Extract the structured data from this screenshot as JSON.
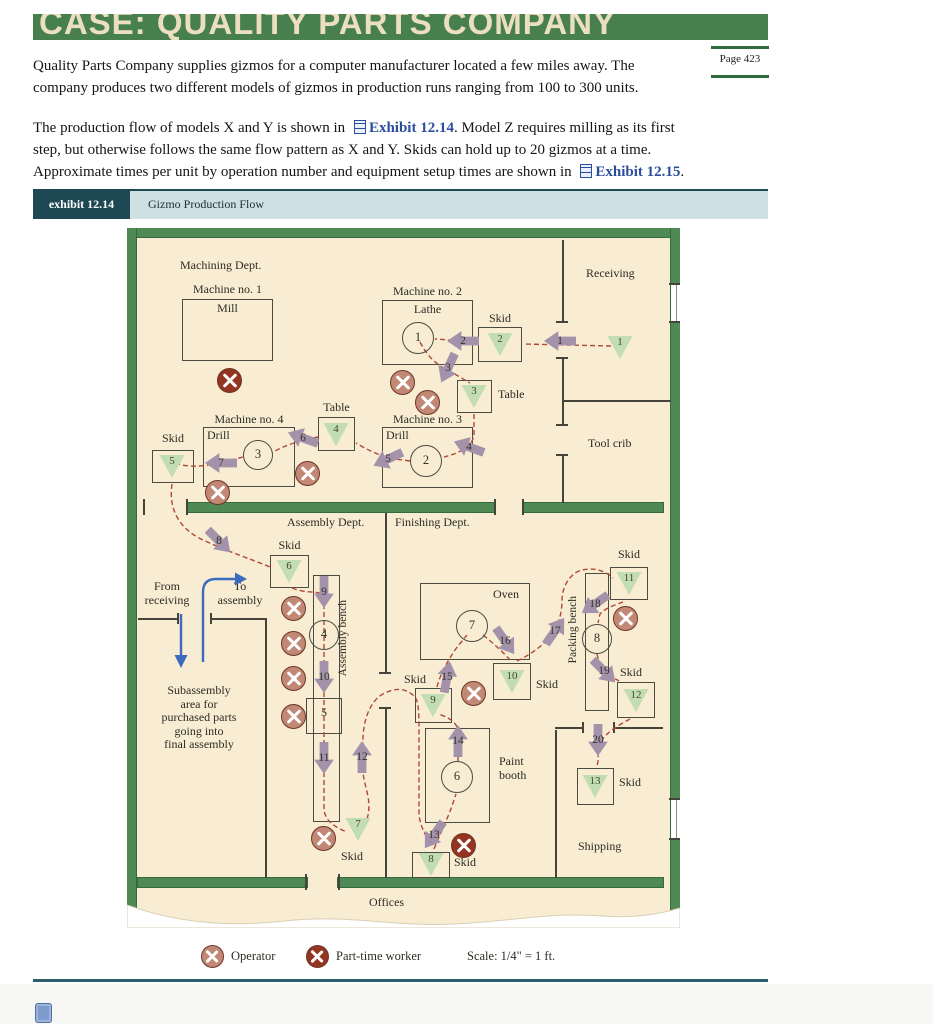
{
  "page": {
    "title": "CASE: QUALITY PARTS COMPANY",
    "page_badge": "Page 423",
    "para1_line1": "Quality Parts Company supplies gizmos for a computer manufacturer located a few miles away. The",
    "para1_line2": "company produces two different models of gizmos in production runs ranging from 100 to 300 units.",
    "para2": {
      "pre1": "The production flow of models X and Y is shown in ",
      "link1": "Exhibit 12.14",
      "mid1": ". Model Z requires milling as its first",
      "line2": "step, but otherwise follows the same flow pattern as X and Y. Skids can hold up to 20 gizmos at a time.",
      "pre3": "Approximate times per unit by operation number and equipment setup times are shown in ",
      "link3": "Exhibit 12.15",
      "post3": "."
    },
    "exhibit_tag": "exhibit 12.14",
    "exhibit_title": "Gizmo Production Flow",
    "legend": {
      "operator": "Operator",
      "part_time": "Part-time worker",
      "scale": "Scale: 1/4\" = 1 ft."
    }
  },
  "colors": {
    "header_green": "#47804e",
    "wall_green": "#4f8a55",
    "floor_cream": "#f8ecd2",
    "exhibit_tag_bg": "#1e4854",
    "exhibit_strip_bg": "#cfdfe4",
    "flow_dash_red": "#b04838",
    "arrow_mauve": "#a392aa",
    "triangle_green": "#c3ddb2",
    "operator_fill": "#c18876",
    "part_time_fill": "#943421",
    "link_blue": "#2b4d9e",
    "blue_arrow": "#3c6cc0"
  },
  "diagram": {
    "green_walls": [
      [
        0,
        0,
        553,
        9
      ],
      [
        0,
        0,
        9,
        690
      ],
      [
        544,
        0,
        9,
        690
      ],
      [
        60,
        275,
        308,
        9
      ],
      [
        396,
        275,
        140,
        9
      ],
      [
        11,
        650,
        169,
        9
      ],
      [
        211,
        650,
        325,
        9
      ]
    ],
    "door_gaps": [
      [
        544,
        57,
        9,
        36
      ],
      [
        544,
        572,
        9,
        38
      ]
    ],
    "black_walls": [
      [
        435,
        12,
        2,
        82
      ],
      [
        435,
        130,
        2,
        67
      ],
      [
        435,
        227,
        2,
        48
      ],
      [
        435,
        172,
        109,
        2
      ],
      [
        11,
        390,
        40,
        2
      ],
      [
        83,
        390,
        55,
        2
      ],
      [
        138,
        390,
        2,
        260
      ],
      [
        258,
        285,
        2,
        160
      ],
      [
        258,
        480,
        2,
        170
      ],
      [
        428,
        502,
        2,
        148
      ],
      [
        428,
        499,
        28,
        2
      ],
      [
        488,
        499,
        48,
        2
      ]
    ],
    "ticks": [
      [
        429,
        93,
        12,
        2
      ],
      [
        429,
        129,
        12,
        2
      ],
      [
        429,
        196,
        12,
        2
      ],
      [
        429,
        226,
        12,
        2
      ],
      [
        50,
        385,
        2,
        11
      ],
      [
        83,
        385,
        2,
        11
      ],
      [
        16,
        271,
        2,
        16
      ],
      [
        59,
        271,
        2,
        16
      ],
      [
        367,
        271,
        2,
        16
      ],
      [
        395,
        271,
        2,
        16
      ],
      [
        178,
        646,
        2,
        16
      ],
      [
        211,
        646,
        2,
        16
      ],
      [
        252,
        444,
        12,
        2
      ],
      [
        252,
        479,
        12,
        2
      ],
      [
        455,
        494,
        2,
        11
      ],
      [
        486,
        494,
        2,
        11
      ],
      [
        542,
        55,
        11,
        2
      ],
      [
        542,
        93,
        11,
        2
      ],
      [
        542,
        570,
        11,
        2
      ],
      [
        542,
        610,
        11,
        2
      ]
    ],
    "boxes": [
      [
        55,
        71,
        91,
        62,
        "mill-box"
      ],
      [
        255,
        72,
        91,
        65,
        "machine2-box"
      ],
      [
        255,
        199,
        91,
        61,
        "machine3-box"
      ],
      [
        76,
        199,
        92,
        60,
        "machine4-box"
      ],
      [
        330,
        152,
        35,
        33,
        "table3-box"
      ],
      [
        191,
        189,
        37,
        34,
        "table4-box"
      ],
      [
        351,
        99,
        44,
        35,
        "skid2-box"
      ],
      [
        25,
        222,
        42,
        33,
        "skid5-box"
      ],
      [
        143,
        327,
        39,
        33,
        "skid6-box"
      ],
      [
        288,
        460,
        37,
        35,
        "skid9-box"
      ],
      [
        366,
        435,
        38,
        37,
        "skid10-box"
      ],
      [
        483,
        339,
        38,
        33,
        "skid11-box"
      ],
      [
        490,
        454,
        38,
        36,
        "skid12-box"
      ],
      [
        450,
        540,
        37,
        37,
        "skid13-box"
      ],
      [
        285,
        624,
        38,
        26,
        "skid8-box"
      ],
      [
        293,
        355,
        110,
        77,
        "oven-box"
      ],
      [
        298,
        500,
        65,
        95,
        "paint-booth-box"
      ],
      [
        186,
        347,
        27,
        247,
        "assembly-bench"
      ],
      [
        458,
        345,
        24,
        138,
        "packing-bench"
      ],
      [
        179,
        470,
        36,
        36,
        "operation5-square"
      ]
    ],
    "circles": [
      [
        1,
        291,
        110,
        16
      ],
      [
        2,
        299,
        233,
        16
      ],
      [
        3,
        131,
        227,
        15
      ],
      [
        4,
        197,
        407,
        15
      ],
      [
        6,
        330,
        549,
        16
      ],
      [
        7,
        345,
        398,
        16
      ],
      [
        8,
        470,
        411,
        15
      ]
    ],
    "triangles": [
      [
        1,
        493,
        119
      ],
      [
        2,
        373,
        116
      ],
      [
        3,
        347,
        168
      ],
      [
        4,
        209,
        206
      ],
      [
        5,
        45,
        238
      ],
      [
        6,
        162,
        343
      ],
      [
        7,
        231,
        601
      ],
      [
        8,
        304,
        636
      ],
      [
        9,
        306,
        477
      ],
      [
        10,
        385,
        453
      ],
      [
        11,
        502,
        355
      ],
      [
        12,
        509,
        472
      ],
      [
        13,
        468,
        558
      ]
    ],
    "arrows": [
      [
        1,
        433,
        113,
        180
      ],
      [
        2,
        336,
        113,
        180
      ],
      [
        3,
        321,
        140,
        115
      ],
      [
        4,
        342,
        219,
        200
      ],
      [
        5,
        261,
        231,
        155
      ],
      [
        6,
        176,
        210,
        200
      ],
      [
        7,
        94,
        235,
        180
      ],
      [
        8,
        92,
        313,
        45
      ],
      [
        9,
        197,
        364,
        90
      ],
      [
        10,
        197,
        449,
        90
      ],
      [
        11,
        197,
        530,
        90
      ],
      [
        12,
        235,
        529,
        -90
      ],
      [
        13,
        307,
        607,
        125
      ],
      [
        14,
        331,
        513,
        -90
      ],
      [
        15,
        320,
        449,
        -80
      ],
      [
        16,
        378,
        413,
        55
      ],
      [
        17,
        428,
        403,
        -55
      ],
      [
        18,
        468,
        376,
        145
      ],
      [
        19,
        477,
        443,
        45
      ],
      [
        20,
        471,
        512,
        90
      ]
    ],
    "operators": [
      [
        "pt",
        102,
        152
      ],
      [
        "op",
        275,
        154
      ],
      [
        "op",
        300,
        174
      ],
      [
        "op",
        180,
        245
      ],
      [
        "op",
        90,
        264
      ],
      [
        "op",
        166,
        380
      ],
      [
        "op",
        166,
        415
      ],
      [
        "op",
        166,
        450
      ],
      [
        "op",
        166,
        488
      ],
      [
        "op",
        346,
        465
      ],
      [
        "op",
        498,
        390
      ],
      [
        "pt",
        336,
        617
      ],
      [
        "op",
        196,
        610
      ]
    ],
    "labels": [
      {
        "t": "Machining Dept.",
        "x": 53,
        "y": 31
      },
      {
        "t": "Machine no. 1",
        "x": 55,
        "y": 55,
        "w": 91,
        "c": 1
      },
      {
        "t": "Mill",
        "x": 55,
        "y": 74,
        "w": 91,
        "c": 1
      },
      {
        "t": "Receiving",
        "x": 459,
        "y": 39
      },
      {
        "t": "Machine no. 2",
        "x": 255,
        "y": 57,
        "w": 91,
        "c": 1
      },
      {
        "t": "Lathe",
        "x": 255,
        "y": 75,
        "w": 91,
        "c": 1
      },
      {
        "t": "Skid",
        "x": 351,
        "y": 84,
        "w": 44,
        "c": 1
      },
      {
        "t": "Table",
        "x": 371,
        "y": 160
      },
      {
        "t": "Machine no. 3",
        "x": 255,
        "y": 185,
        "w": 91,
        "c": 1
      },
      {
        "t": "Drill",
        "x": 259,
        "y": 201
      },
      {
        "t": "Tool crib",
        "x": 461,
        "y": 209
      },
      {
        "t": "Machine no. 4",
        "x": 76,
        "y": 185,
        "w": 92,
        "c": 1
      },
      {
        "t": "Drill",
        "x": 80,
        "y": 201
      },
      {
        "t": "Table",
        "x": 191,
        "y": 173,
        "w": 37,
        "c": 1
      },
      {
        "t": "Skid",
        "x": 25,
        "y": 204,
        "w": 42,
        "c": 1
      },
      {
        "t": "Assembly Dept.",
        "x": 160,
        "y": 288
      },
      {
        "t": "Finishing Dept.",
        "x": 268,
        "y": 288
      },
      {
        "t": "Skid",
        "x": 143,
        "y": 311,
        "w": 39,
        "c": 1
      },
      {
        "t": "From\nreceiving",
        "x": 10,
        "y": 352,
        "w": 60,
        "c": 1
      },
      {
        "t": "To\nassembly",
        "x": 84,
        "y": 352,
        "w": 58,
        "c": 1
      },
      {
        "t": "Subassembly\narea for\npurchased parts\ngoing into\nfinal assembly",
        "x": 18,
        "y": 456,
        "w": 108,
        "c": 1
      },
      {
        "t": "Oven",
        "x": 366,
        "y": 360
      },
      {
        "t": "Skid",
        "x": 277,
        "y": 445
      },
      {
        "t": "Skid",
        "x": 409,
        "y": 450
      },
      {
        "t": "Skid",
        "x": 483,
        "y": 320,
        "w": 38,
        "c": 1
      },
      {
        "t": "Skid",
        "x": 493,
        "y": 438
      },
      {
        "t": "Paint\nbooth",
        "x": 372,
        "y": 527
      },
      {
        "t": "Skid",
        "x": 214,
        "y": 622
      },
      {
        "t": "Skid",
        "x": 327,
        "y": 628
      },
      {
        "t": "Skid",
        "x": 492,
        "y": 548
      },
      {
        "t": "Shipping",
        "x": 451,
        "y": 612
      },
      {
        "t": "Offices",
        "x": 242,
        "y": 668
      },
      {
        "t": "5",
        "x": 179,
        "y": 478,
        "w": 36,
        "c": 1
      }
    ],
    "rot_labels": [
      {
        "t": "Assembly bench",
        "x": 210,
        "y": 372
      },
      {
        "t": "Packing bench",
        "x": 440,
        "y": 368
      }
    ]
  }
}
